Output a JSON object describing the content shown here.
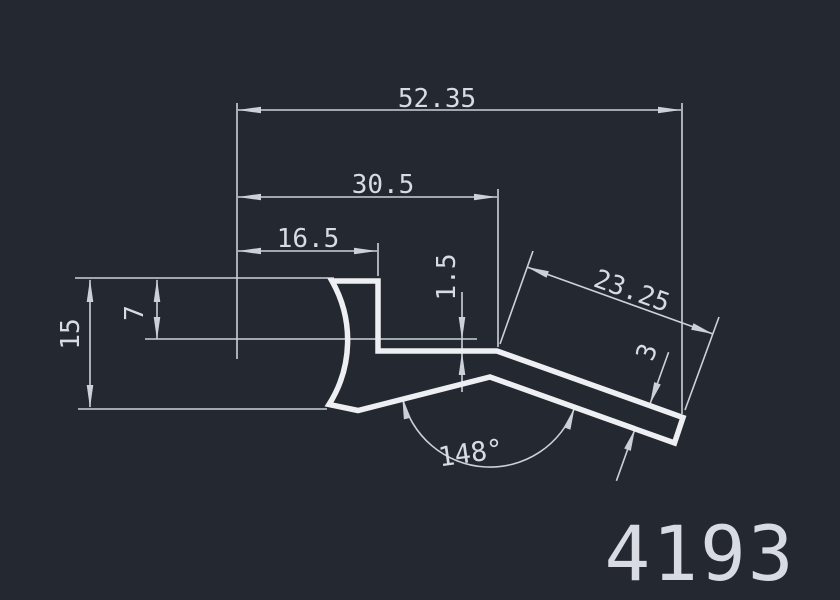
{
  "drawing": {
    "part_number": "4193",
    "dims": {
      "overall_width": "52.35",
      "upper_width": "30.5",
      "top_width": "16.5",
      "height_total": "15",
      "height_upper": "7",
      "step_thickness": "1.5",
      "arm_length": "23.25",
      "arm_thickness": "3",
      "bend_angle": "148°"
    },
    "colors": {
      "background": "#232831",
      "profile": "#edeff3",
      "dim": "#ccd1d8",
      "text": "#d8dce2"
    }
  }
}
